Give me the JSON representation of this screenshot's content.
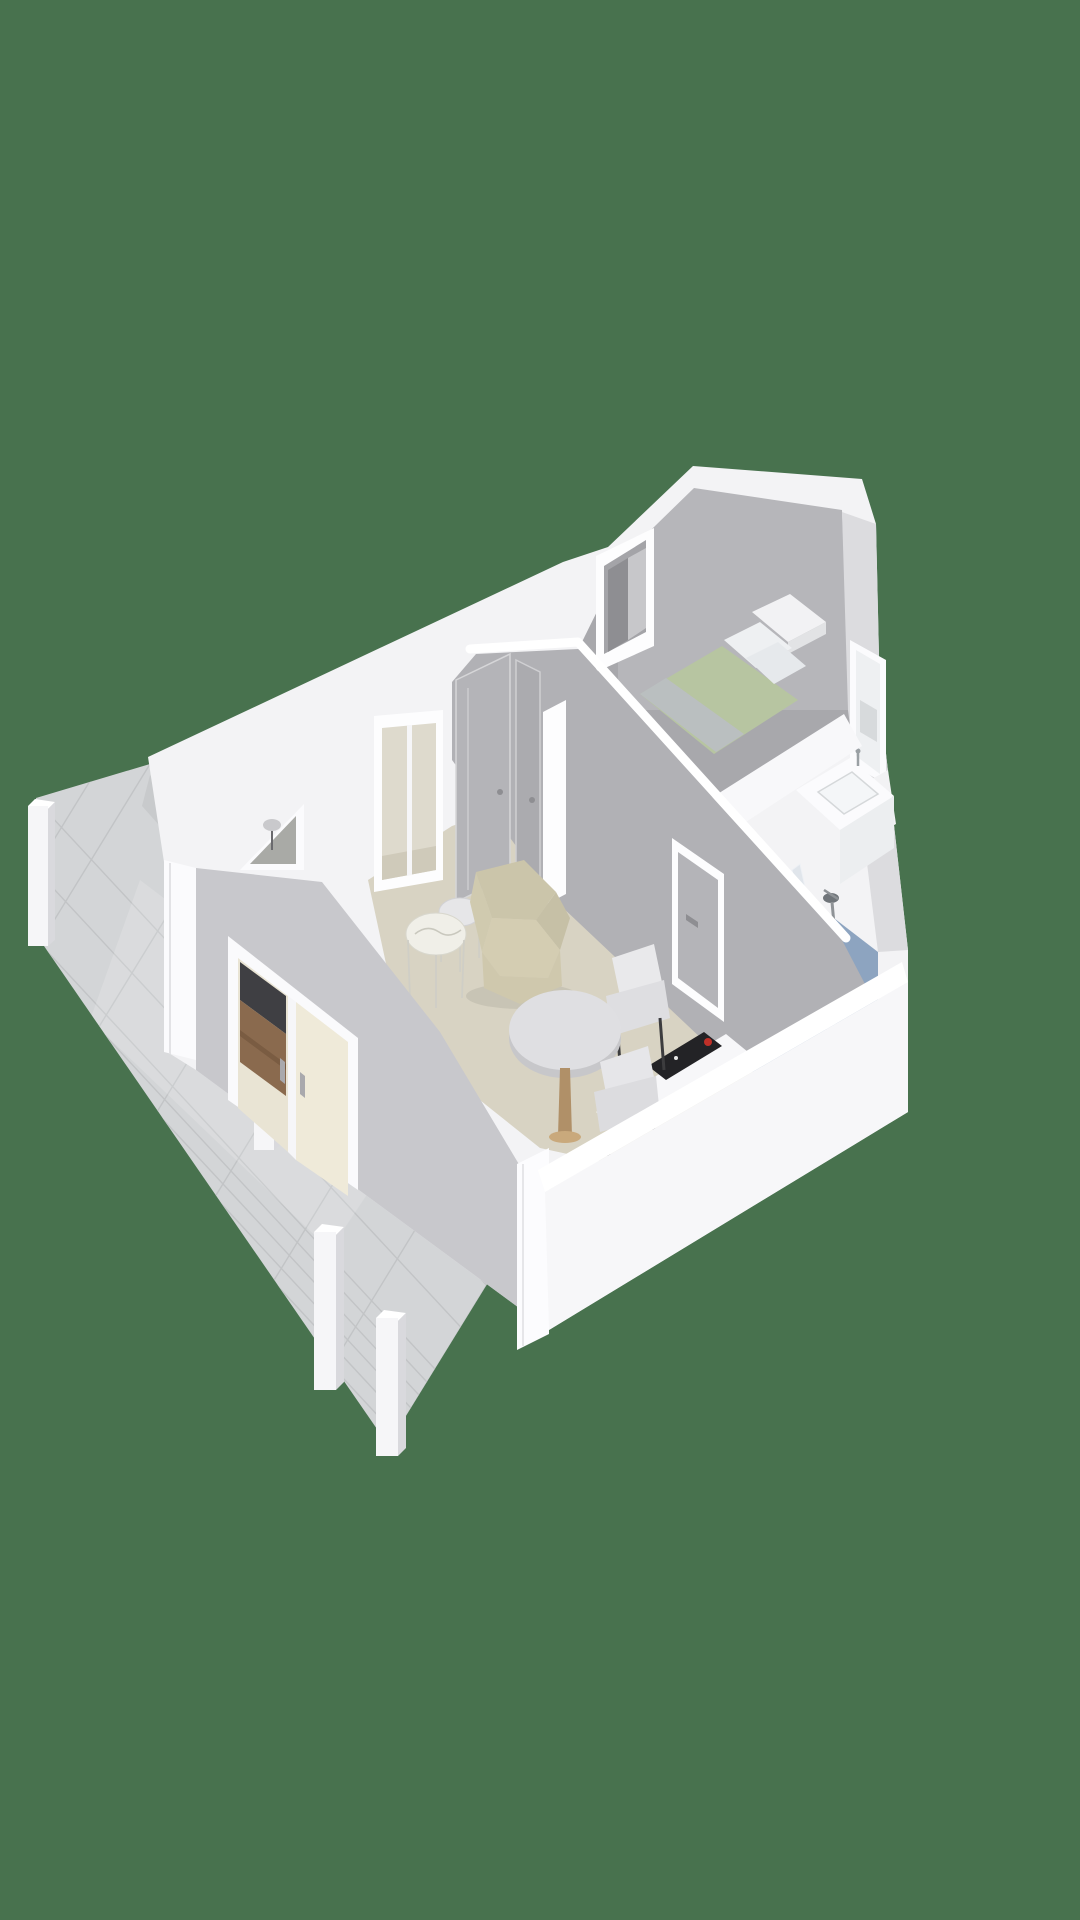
{
  "scene": {
    "type": "3d-floorplan-render",
    "description": "Isometric 3D floor plan of an attic studio apartment with terrace, viewed from above at an angle",
    "background_color": "#48724e"
  },
  "colors": {
    "background": "#48724e",
    "wall_white": "#f3f3f5",
    "wall_band_white": "#ffffff",
    "wall_gray_interior": "#b1b1b5",
    "far_gable_gray": "#b6b6ba",
    "right_wall_gray": "#dcdcdf",
    "facade_gray": "#c8c8cc",
    "floor_living_beige": "#d8d3c3",
    "floor_bedroom_gray": "#a8a8ac",
    "floor_bathroom_blue": "#8da4c0",
    "terrace_tile_gray": "#d3d5d7",
    "tile_grout": "#c2c4c6",
    "bed_duvet_sage": "#b7c5a1",
    "bed_linen_white": "#eef0f2",
    "armchair_beige": "#d4cdb2",
    "table_wood": "#b09068",
    "door_gray": "#b4b4b8",
    "cooktop_black": "#232326",
    "cooktop_red_accent": "#c03028",
    "shower_glass_blue": "#cfd9e3",
    "cabinet_wood_brown": "#8a6a4e",
    "tv_dark": "#3f3f43"
  },
  "rooms": [
    {
      "id": "living-dining-room",
      "floor_color_key": "floor_living_beige"
    },
    {
      "id": "bedroom",
      "floor_color_key": "floor_bedroom_gray"
    },
    {
      "id": "bathroom",
      "floor_color_key": "floor_bathroom_blue"
    },
    {
      "id": "hallway",
      "floor_color_key": "floor_living_beige"
    },
    {
      "id": "terrace",
      "floor_color_key": "terrace_tile_gray"
    }
  ],
  "furniture": [
    "wingback-armchair",
    "nesting-side-table-large",
    "nesting-side-table-small",
    "round-dining-table",
    "dining-chair-1",
    "dining-chair-2",
    "double-bed-with-sage-duvet",
    "bed-pillows",
    "headboard",
    "bathroom-vanity-with-sink",
    "shower-with-glass-panel",
    "toilet-partition-block",
    "kitchenette-counter",
    "induction-cooktop",
    "tv-and-wood-cabinet-behind-glass",
    "floor-lamp-behind-triangle-window",
    "wardrobe-behind-dormer-window"
  ],
  "openings": [
    "french-doors-to-terrace",
    "triangular-gable-window",
    "balcony-window",
    "bedroom-dormer-window",
    "bathroom-window",
    "hallway-double-doors",
    "bathroom-door"
  ],
  "terrace": {
    "posts": 4,
    "tile_pattern": "square-grid"
  }
}
